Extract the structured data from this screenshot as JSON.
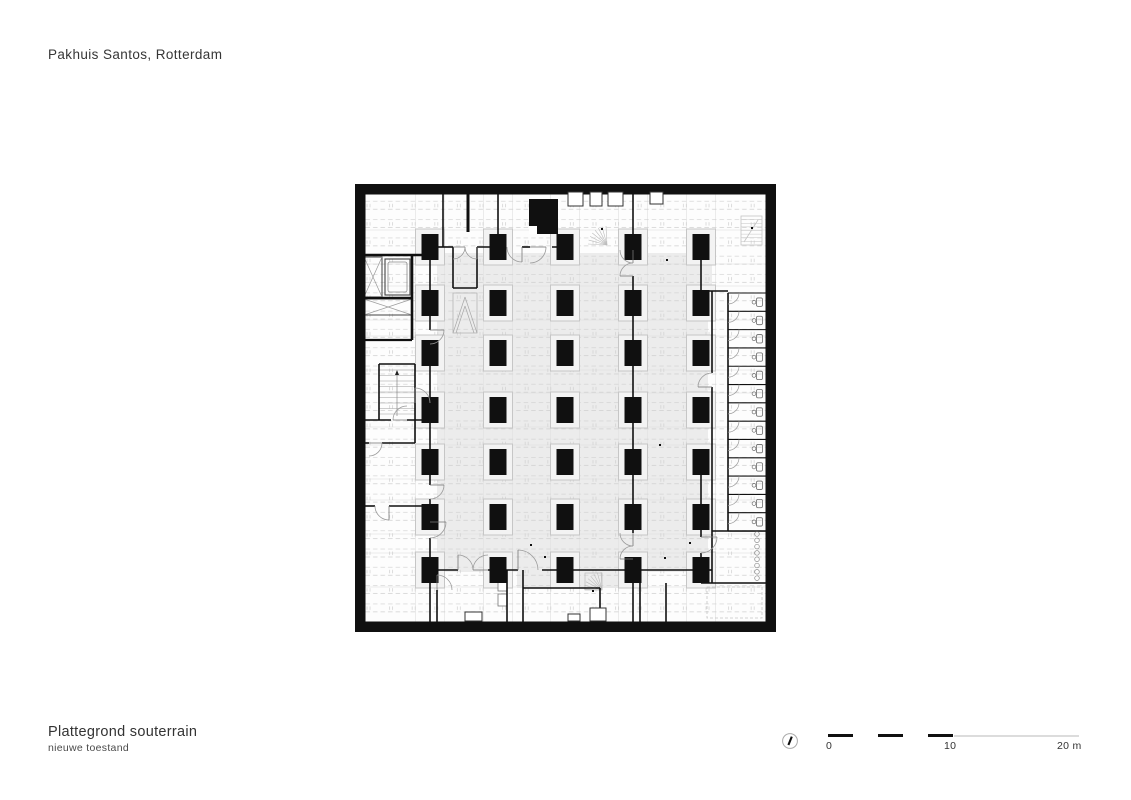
{
  "header": {
    "project_title": "Pakhuis Santos, Rotterdam"
  },
  "footer": {
    "title": "Plattegrond souterrain",
    "subtitle": "nieuwe toestand"
  },
  "scale_bar": {
    "labels": [
      "0",
      "10",
      "20 m"
    ],
    "meters_per_black_segment": 2,
    "px_per_meter": 12.53
  },
  "north_arrow": {
    "shape": "circle-with-needle"
  },
  "colors": {
    "wall": "#101010",
    "field": "#ececec",
    "bg": "#fdfdfd",
    "hatch": "#cfcfcf",
    "strip": "#e3e3e3",
    "plate_stroke": "#c6c6c6",
    "plate_fill": "#f3f3f3",
    "door": "#9a9a9a",
    "ghost": "#c4c4c4",
    "fixture": "#6a6a6a"
  },
  "plan": {
    "width": 421,
    "height": 448,
    "wallThickness": 10.5,
    "colXs": [
      75,
      143,
      210,
      278,
      346
    ],
    "rowYs": [
      63,
      119,
      169,
      226,
      278,
      333,
      386
    ],
    "column": {
      "w": 17,
      "h": 26
    },
    "plate": {
      "w": 29,
      "h": 36
    },
    "grayFields": [
      [
        82,
        69,
        271,
        319
      ],
      [
        162,
        388,
        126,
        16
      ],
      [
        345,
        66,
        12,
        41
      ]
    ],
    "walls": [
      [
        9,
        71,
        83,
        71,
        2.6
      ],
      [
        57,
        71,
        57,
        156,
        2.6
      ],
      [
        9,
        114,
        57,
        114,
        2.6
      ],
      [
        9,
        156,
        57,
        156,
        2.2
      ],
      [
        9,
        236,
        36,
        236
      ],
      [
        52,
        236,
        75,
        236
      ],
      [
        60,
        236,
        60,
        259
      ],
      [
        9,
        259,
        14,
        259
      ],
      [
        27,
        259,
        60,
        259
      ],
      [
        9,
        322,
        20,
        322
      ],
      [
        34,
        322,
        75,
        322
      ],
      [
        24,
        180,
        60,
        180
      ],
      [
        24,
        180,
        24,
        236
      ],
      [
        60,
        180,
        60,
        236
      ],
      [
        75,
        63,
        75,
        146
      ],
      [
        75,
        160,
        75,
        301
      ],
      [
        75,
        315,
        75,
        338
      ],
      [
        75,
        354,
        75,
        386
      ],
      [
        75,
        386,
        75,
        437.5
      ],
      [
        88,
        10.5,
        88,
        63
      ],
      [
        113,
        10.5,
        113,
        48,
        3
      ],
      [
        143,
        10.5,
        143,
        63
      ],
      [
        83,
        63,
        98,
        63
      ],
      [
        122,
        63,
        150,
        63
      ],
      [
        167,
        63,
        175,
        63
      ],
      [
        197,
        63,
        218,
        63
      ],
      [
        98,
        63,
        98,
        104
      ],
      [
        122,
        63,
        122,
        104
      ],
      [
        98,
        104,
        122,
        104
      ],
      [
        270,
        63,
        286,
        63
      ],
      [
        338,
        63,
        354,
        63
      ],
      [
        278,
        10.5,
        278,
        66
      ],
      [
        278,
        92,
        278,
        349
      ],
      [
        278,
        375,
        278,
        437.5
      ],
      [
        346,
        63,
        346,
        107
      ],
      [
        346,
        278,
        346,
        353
      ],
      [
        346,
        369,
        346,
        399
      ],
      [
        345,
        107,
        373,
        107
      ],
      [
        357,
        107,
        357,
        189
      ],
      [
        357,
        203,
        357,
        399
      ],
      [
        373,
        109,
        373,
        347
      ],
      [
        357,
        347,
        410.5,
        347
      ],
      [
        346,
        399,
        410.5,
        399
      ],
      [
        82,
        386,
        82,
        391
      ],
      [
        82,
        406,
        82,
        437.5
      ],
      [
        152,
        386,
        152,
        437.5
      ],
      [
        168,
        386,
        168,
        437.5
      ],
      [
        168,
        404,
        245,
        404
      ],
      [
        245,
        404,
        245,
        437.5
      ],
      [
        285,
        399,
        285,
        437.5
      ],
      [
        311,
        399,
        311,
        437.5
      ],
      [
        75,
        386,
        103,
        386
      ],
      [
        133,
        386,
        163,
        386
      ],
      [
        187,
        386,
        278,
        386
      ],
      [
        286,
        386,
        338,
        386
      ],
      [
        354,
        386,
        357,
        386
      ]
    ],
    "arcs": [
      [
        98,
        63,
        12,
        1
      ],
      [
        122,
        63,
        12,
        2
      ],
      [
        167,
        63,
        15,
        2
      ],
      [
        175,
        63,
        16,
        1
      ],
      [
        278,
        66,
        13,
        2
      ],
      [
        278,
        92,
        13,
        3
      ],
      [
        52,
        236,
        14,
        3
      ],
      [
        14,
        259,
        13,
        1
      ],
      [
        34,
        322,
        14,
        2
      ],
      [
        75,
        146,
        14,
        1
      ],
      [
        75,
        301,
        14,
        1
      ],
      [
        75,
        338,
        16,
        1
      ],
      [
        103,
        386,
        15,
        4
      ],
      [
        133,
        386,
        15,
        3
      ],
      [
        163,
        386,
        20,
        4
      ],
      [
        357,
        203,
        14,
        3
      ],
      [
        346,
        353,
        16,
        1
      ],
      [
        278,
        349,
        13,
        2
      ],
      [
        278,
        375,
        13,
        3
      ],
      [
        60,
        219,
        15,
        4
      ],
      [
        82,
        406,
        15,
        4
      ]
    ],
    "cells": {
      "x": 373,
      "xRight": 410.5,
      "yTop": 109,
      "pitch": 18.31,
      "count": 13
    },
    "urinals": {
      "x": 402,
      "yTop": 350,
      "step": 6.3,
      "count": 8,
      "r": 2.3
    },
    "niches": [
      [
        213,
        8,
        15,
        14
      ],
      [
        235,
        8,
        12,
        14
      ],
      [
        253,
        8,
        15,
        14
      ],
      [
        295,
        8,
        13,
        12
      ]
    ],
    "blackRects": [
      [
        174,
        15,
        29,
        35
      ]
    ],
    "whiteNotches": [
      [
        174,
        42,
        8,
        8
      ]
    ],
    "xBoxes": [
      [
        9,
        73,
        18,
        40
      ],
      [
        9,
        115,
        48,
        16
      ]
    ],
    "elevatorCar": {
      "outer": [
        30,
        75,
        25,
        36
      ],
      "inner": [
        33,
        78,
        19,
        30
      ]
    },
    "bottomBoxes": [
      [
        110,
        428,
        17,
        9
      ],
      [
        213,
        430,
        12,
        7
      ],
      [
        235,
        424,
        16,
        13
      ]
    ],
    "closetBoxes": [
      [
        143,
        398,
        9,
        9
      ],
      [
        143,
        410,
        9,
        12
      ]
    ],
    "chevron": {
      "box": [
        98,
        109,
        24,
        40
      ],
      "lines": [
        [
          98,
          149,
          110,
          113
        ],
        [
          110,
          113,
          122,
          149
        ],
        [
          101,
          149,
          110,
          122
        ],
        [
          110,
          122,
          119,
          149
        ]
      ]
    },
    "dashedRooms": [
      [
        352,
        403,
        55,
        31
      ]
    ],
    "ghostStair": {
      "x": 386,
      "y": 32,
      "w": 21,
      "h": 29,
      "lines": 8
    },
    "fans": [
      {
        "cx": 252,
        "cy": 61,
        "r": 19,
        "a0": 183,
        "a1": 267,
        "n": 8
      },
      {
        "cx": 247,
        "cy": 406,
        "r": 18,
        "a0": 183,
        "a1": 267,
        "n": 8
      }
    ],
    "fanSquare": [
      230,
      389,
      17,
      17
    ],
    "stair": {
      "x": 24,
      "y": 180,
      "w": 36,
      "h": 56,
      "stepGap": 5.5
    },
    "dots": [
      [
        312,
        76
      ],
      [
        305,
        261
      ],
      [
        176,
        361
      ],
      [
        335,
        359
      ],
      [
        310,
        374
      ],
      [
        190,
        373
      ],
      [
        238,
        407
      ],
      [
        247,
        45
      ],
      [
        397,
        44
      ]
    ]
  }
}
